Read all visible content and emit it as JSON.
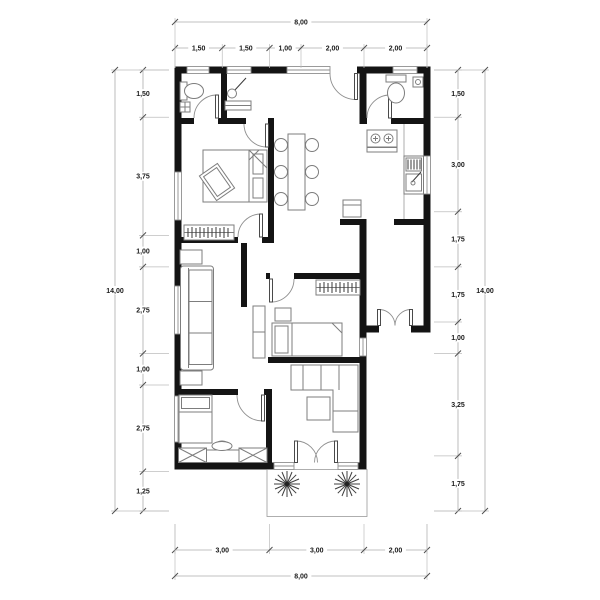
{
  "drawing": {
    "kind": "house floor plan",
    "units_note": "dimensions in meters, comma decimal"
  },
  "colors": {
    "wall": "#141414",
    "furniture_line": "#7d7d7d",
    "dimension_line": "#ababab",
    "dimension_text": "#1a1a1a",
    "background": "#ffffff"
  },
  "dimensions": {
    "top": {
      "total": {
        "label": "8,00",
        "m": 8
      },
      "segments": [
        {
          "label": "1,50",
          "m": 1.5
        },
        {
          "label": "1,50",
          "m": 1.5
        },
        {
          "label": "1,00",
          "m": 1.0
        },
        {
          "label": "2,00",
          "m": 2.0
        },
        {
          "label": "2,00",
          "m": 2.0
        }
      ]
    },
    "bottom": {
      "total": {
        "label": "8,00",
        "m": 8
      },
      "segments": [
        {
          "label": "3,00",
          "m": 3.0
        },
        {
          "label": "3,00",
          "m": 3.0
        },
        {
          "label": "2,00",
          "m": 2.0
        }
      ]
    },
    "left": {
      "total": {
        "label": "14,00",
        "m": 14
      },
      "segments": [
        {
          "label": "1,50",
          "m": 1.5
        },
        {
          "label": "3,75",
          "m": 3.75
        },
        {
          "label": "1,00",
          "m": 1.0
        },
        {
          "label": "2,75",
          "m": 2.75
        },
        {
          "label": "1,00",
          "m": 1.0
        },
        {
          "label": "2,75",
          "m": 2.75
        },
        {
          "label": "1,25",
          "m": 1.25
        }
      ]
    },
    "right": {
      "total": {
        "label": "14,00",
        "m": 14
      },
      "segments": [
        {
          "label": "1,50",
          "m": 1.5
        },
        {
          "label": "3,00",
          "m": 3.0
        },
        {
          "label": "1,75",
          "m": 1.75
        },
        {
          "label": "1,75",
          "m": 1.75
        },
        {
          "label": "1,00",
          "m": 1.0
        },
        {
          "label": "3,25",
          "m": 3.25
        },
        {
          "label": "1,75",
          "m": 1.75
        }
      ]
    }
  },
  "symbols": [
    "toilet-icon",
    "shower-icon",
    "washbasin-icon",
    "double-bed-icon",
    "single-bed-icon",
    "wardrobe-icon",
    "dining-table-icon",
    "chair-icon",
    "stove-icon",
    "kitchen-sink-icon",
    "refrigerator-icon",
    "sofa-icon",
    "sectional-sofa-icon",
    "coffee-table-icon",
    "desk-icon",
    "cabinet-icon",
    "rug-icon",
    "plant-icon",
    "door-swing-icon",
    "window-icon"
  ]
}
